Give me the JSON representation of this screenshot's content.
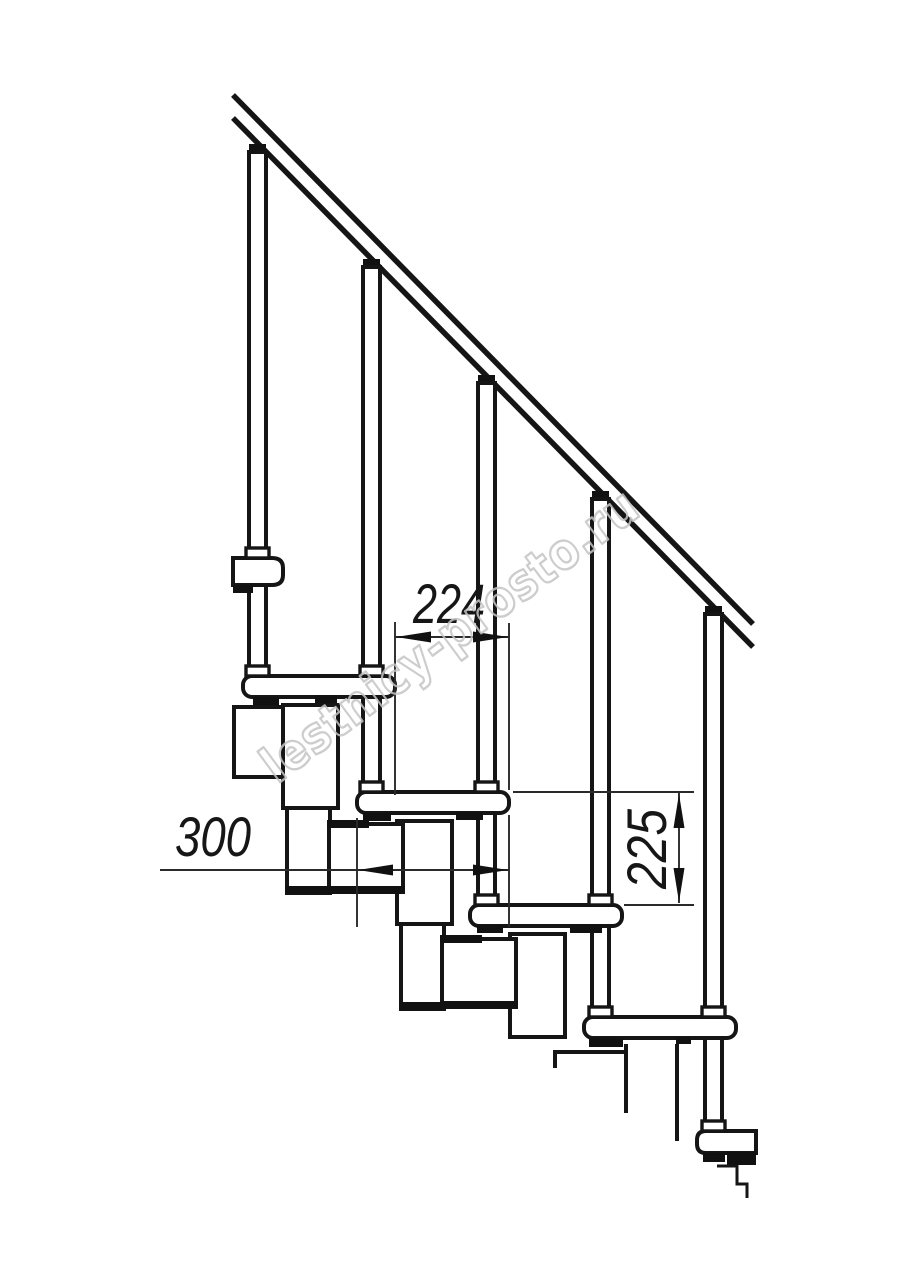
{
  "page": {
    "background": "#ffffff",
    "line_color": "#151515"
  },
  "drawing": {
    "watermark": {
      "text": "lestnicy-prosto.ru",
      "color": "#c4c4c4"
    },
    "dimensions": {
      "run": {
        "value": "224",
        "orientation": "horizontal"
      },
      "tread_depth": {
        "value": "300",
        "orientation": "horizontal"
      },
      "rise": {
        "value": "225",
        "orientation": "vertical"
      }
    }
  }
}
